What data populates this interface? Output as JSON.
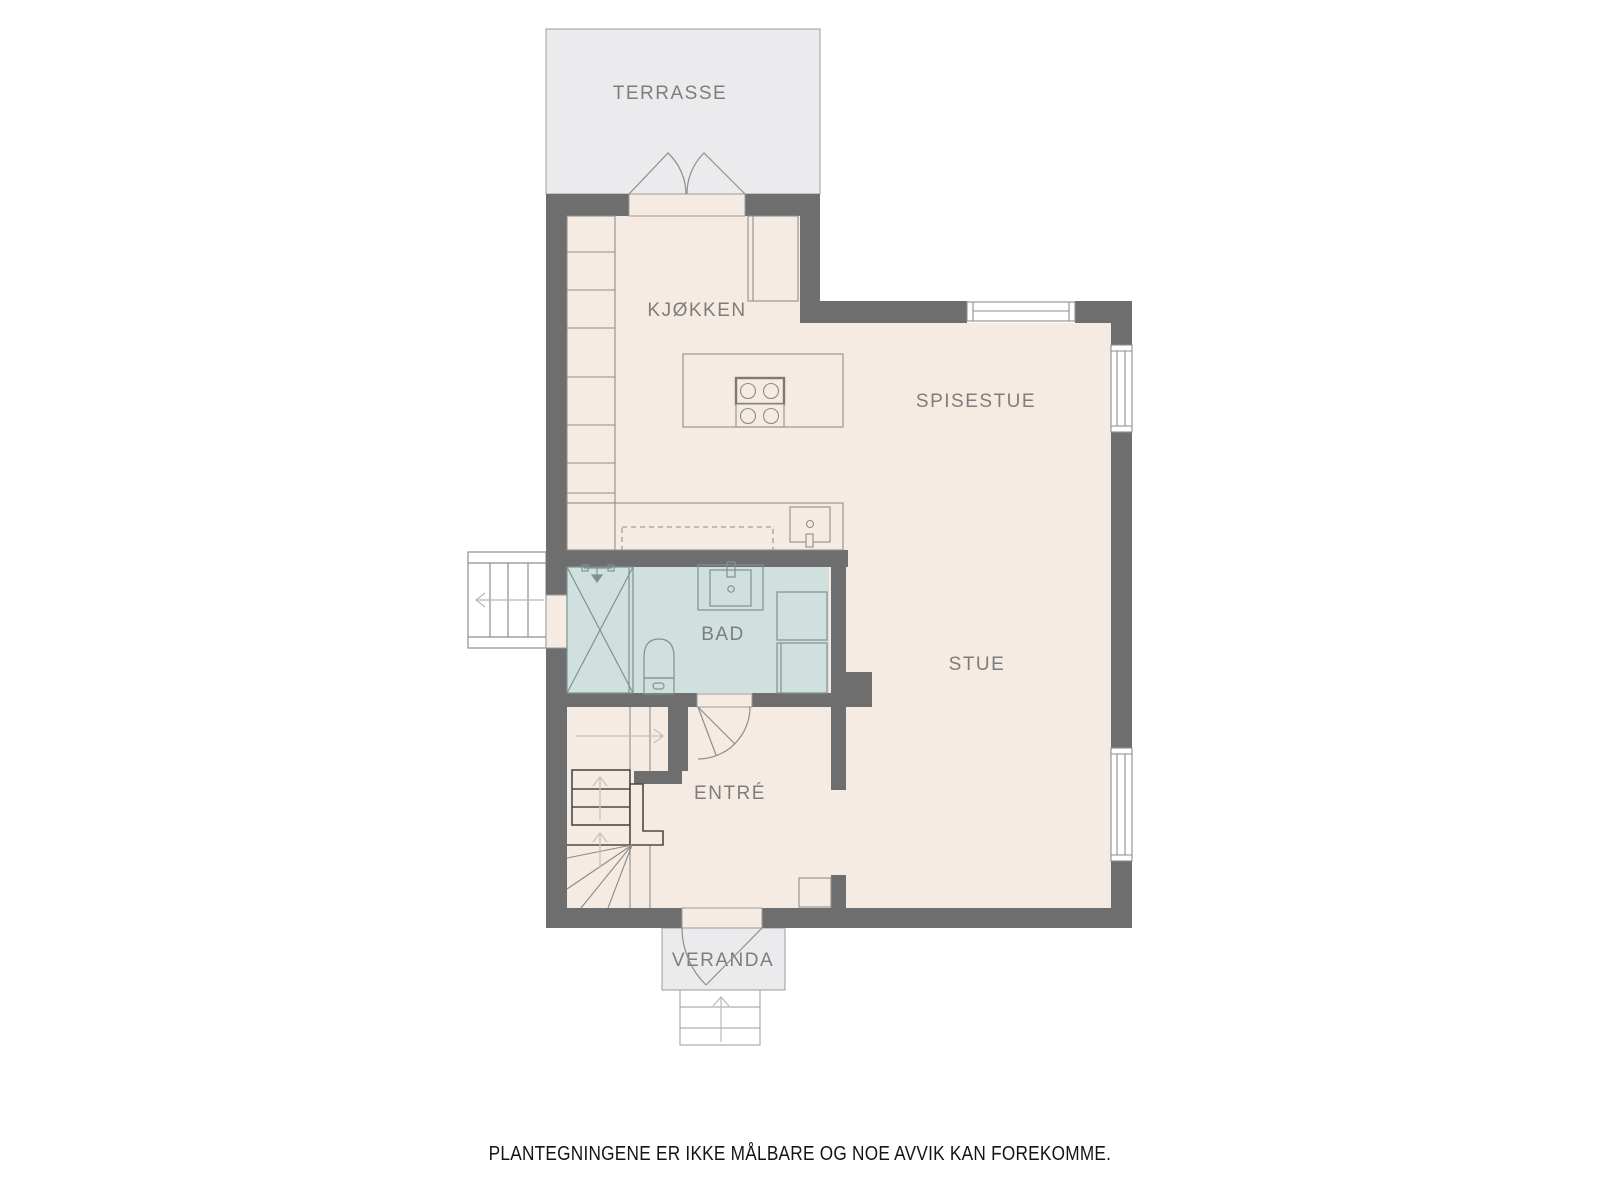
{
  "floorplan": {
    "title": "floor-plan",
    "rooms": {
      "terrasse": {
        "label": "TERRASSE"
      },
      "kitchen": {
        "label": "KJØKKEN"
      },
      "dining": {
        "label": "SPISESTUE"
      },
      "living": {
        "label": "STUE"
      },
      "bath": {
        "label": "BAD"
      },
      "entry": {
        "label": "ENTRÉ"
      },
      "veranda": {
        "label": "VERANDA"
      }
    },
    "disclaimer": "PLANTEGNINGENE ER IKKE MÅLBARE OG NOE AVVIK KAN FOREKOMME.",
    "colors": {
      "wall": "#6e6e6e",
      "floor": "#f6ebe3",
      "bath_floor": "#cfe0df",
      "outdoor": "#ebebed",
      "fixture_line": "#8e8e8e",
      "label_text": "#7d7d7d",
      "disclaimer_text": "#141414",
      "stair_arrow": "#c9c1b9",
      "window_fill": "#ffffff"
    }
  }
}
